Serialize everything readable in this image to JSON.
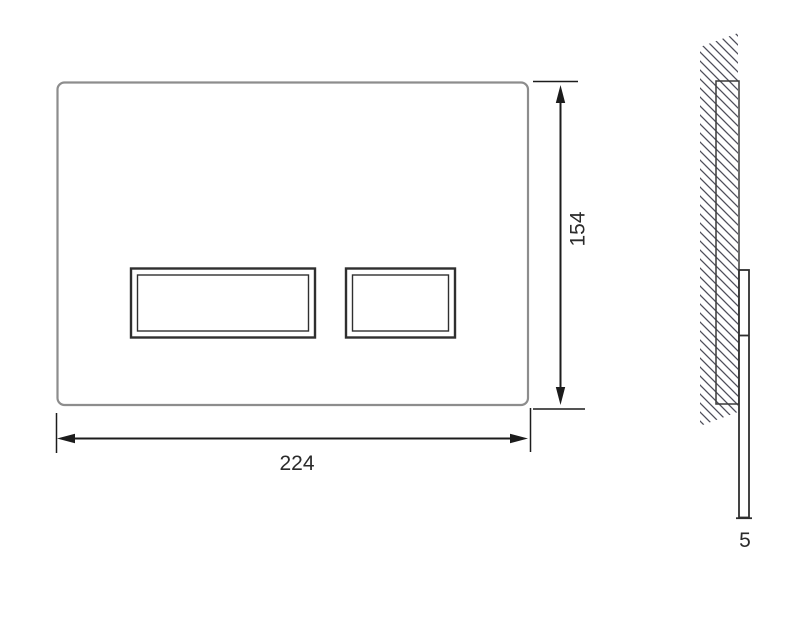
{
  "colors": {
    "page_background": "#ffffff",
    "dimension_line": "#1c1c1c",
    "plate_outline": "#8d8d8d",
    "button_outline": "#2f2f2f",
    "hatch_line": "#4d4d59",
    "side_outline": "#3c3c3c",
    "label_text": "#2b2b2b"
  },
  "dimensions": {
    "width": {
      "label": "224"
    },
    "height": {
      "label": "154"
    },
    "thickness": {
      "label": "5"
    }
  }
}
